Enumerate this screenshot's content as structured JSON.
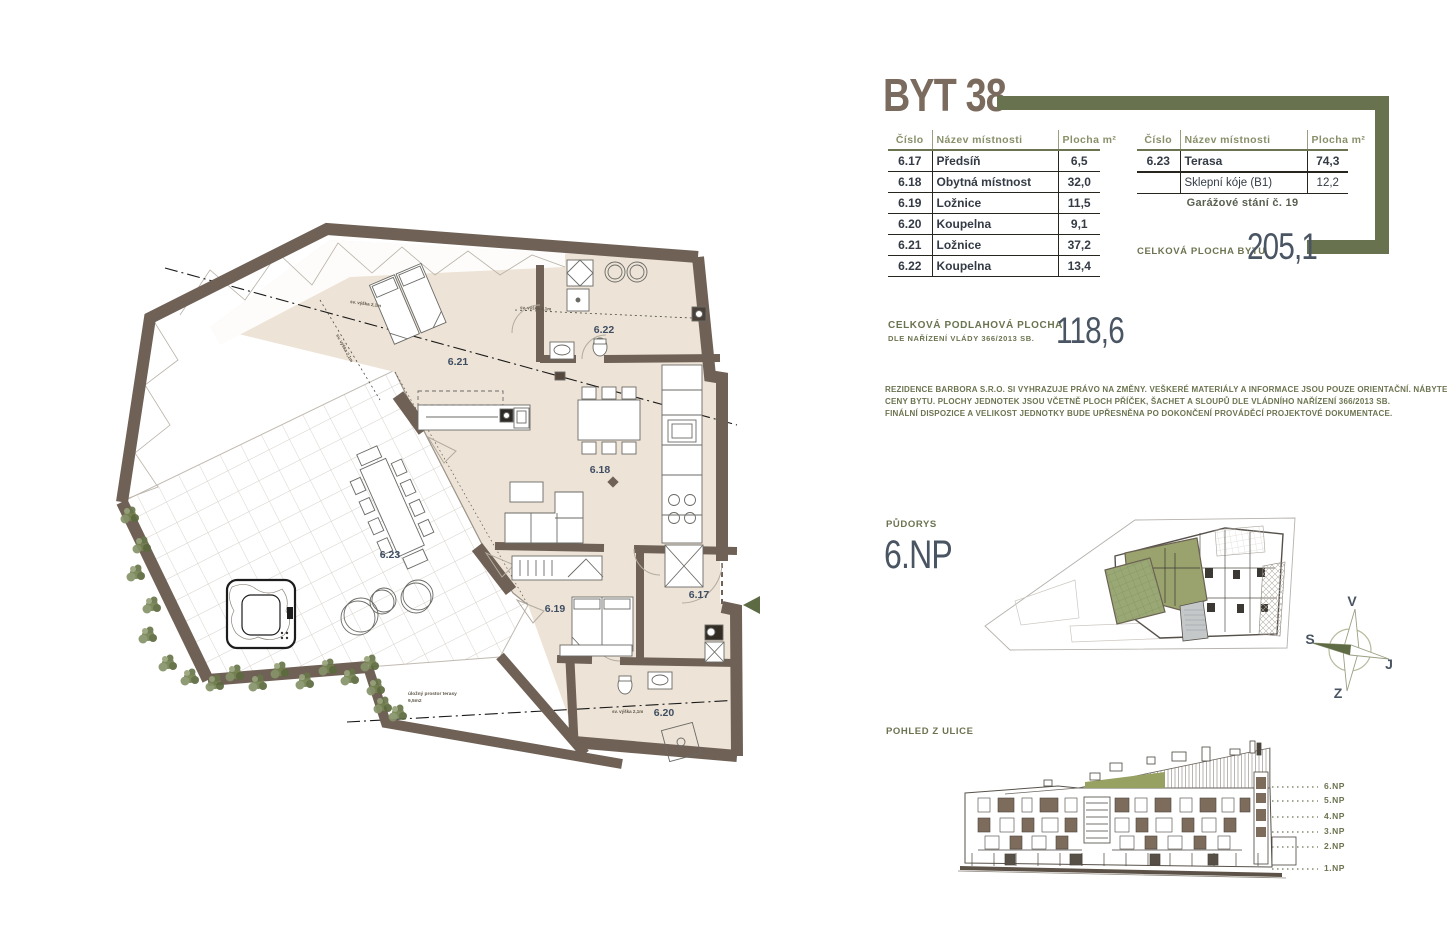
{
  "title": "BYT 38",
  "colors": {
    "accent_olive": "#68724f",
    "wall_brown": "#6f6156",
    "floor_beige": "#ede3d6",
    "number_slate": "#4a5563",
    "title_brown": "#7b6b5e"
  },
  "tables": {
    "headers": {
      "num": "Číslo",
      "name": "Název místnosti",
      "area": "Plocha m²"
    },
    "left_rows": [
      {
        "num": "6.17",
        "name": "Předsíň",
        "area": "6,5"
      },
      {
        "num": "6.18",
        "name": "Obytná místnost",
        "area": "32,0"
      },
      {
        "num": "6.19",
        "name": "Ložnice",
        "area": "11,5"
      },
      {
        "num": "6.20",
        "name": "Koupelna",
        "area": "9,1"
      },
      {
        "num": "6.21",
        "name": "Ložnice",
        "area": "37,2"
      },
      {
        "num": "6.22",
        "name": "Koupelna",
        "area": "13,4"
      }
    ],
    "right_rows": [
      {
        "num": "6.23",
        "name": "Terasa",
        "area": "74,3"
      },
      {
        "num": "",
        "name": "Sklepní kóje (B1)",
        "area": "12,2"
      }
    ],
    "garage_note": "Garážové stání č. 19"
  },
  "totals": {
    "apartment_label": "CELKOVÁ PLOCHA BYTU",
    "apartment_value": "205,1",
    "floor_label": "CELKOVÁ PODLAHOVÁ PLOCHA",
    "floor_sublabel": "DLE NAŘÍZENÍ VLÁDY 366/2013 SB.",
    "floor_value": "118,6"
  },
  "disclaimer": {
    "line1": "REZIDENCE BARBORA S.R.O. SI VYHRAZUJE PRÁVO NA ZMĚNY. VEŠKERÉ MATERIÁLY A INFORMACE JSOU POUZE ORIENTAČNÍ. NÁBYTEK NENÍ SOUČÁSTÍ KUPNÍ",
    "line2": "CENY BYTU. PLOCHY JEDNOTEK JSOU VČETNĚ PLOCH PŘÍČEK, ŠACHET A SLOUPŮ DLE VLÁDNÍHO NAŘÍZENÍ 366/2013 SB.",
    "line3": "FINÁLNÍ DISPOZICE A VELIKOST JEDNOTKY BUDE UPŘESNĚNA PO DOKONČENÍ PROVÁDĚCÍ PROJEKTOVÉ DOKUMENTACE."
  },
  "plan": {
    "section_label": "PŮDORYS",
    "floor": "6.NP",
    "room_labels": {
      "r617": "6.17",
      "r618": "6.18",
      "r619": "6.19",
      "r620": "6.20",
      "r621": "6.21",
      "r622": "6.22",
      "r623": "6.23"
    },
    "annotations": {
      "height": "sv. výška 2,1m",
      "storage_line1": "úložný prostor terasy",
      "storage_line2": "9,5m2"
    }
  },
  "compass": {
    "top": "V",
    "left": "S",
    "right": "J",
    "bottom": "Z"
  },
  "elevation": {
    "section_label": "POHLED Z ULICE",
    "floors": [
      "6.NP",
      "5.NP",
      "4.NP",
      "3.NP",
      "2.NP",
      "1.NP"
    ]
  }
}
